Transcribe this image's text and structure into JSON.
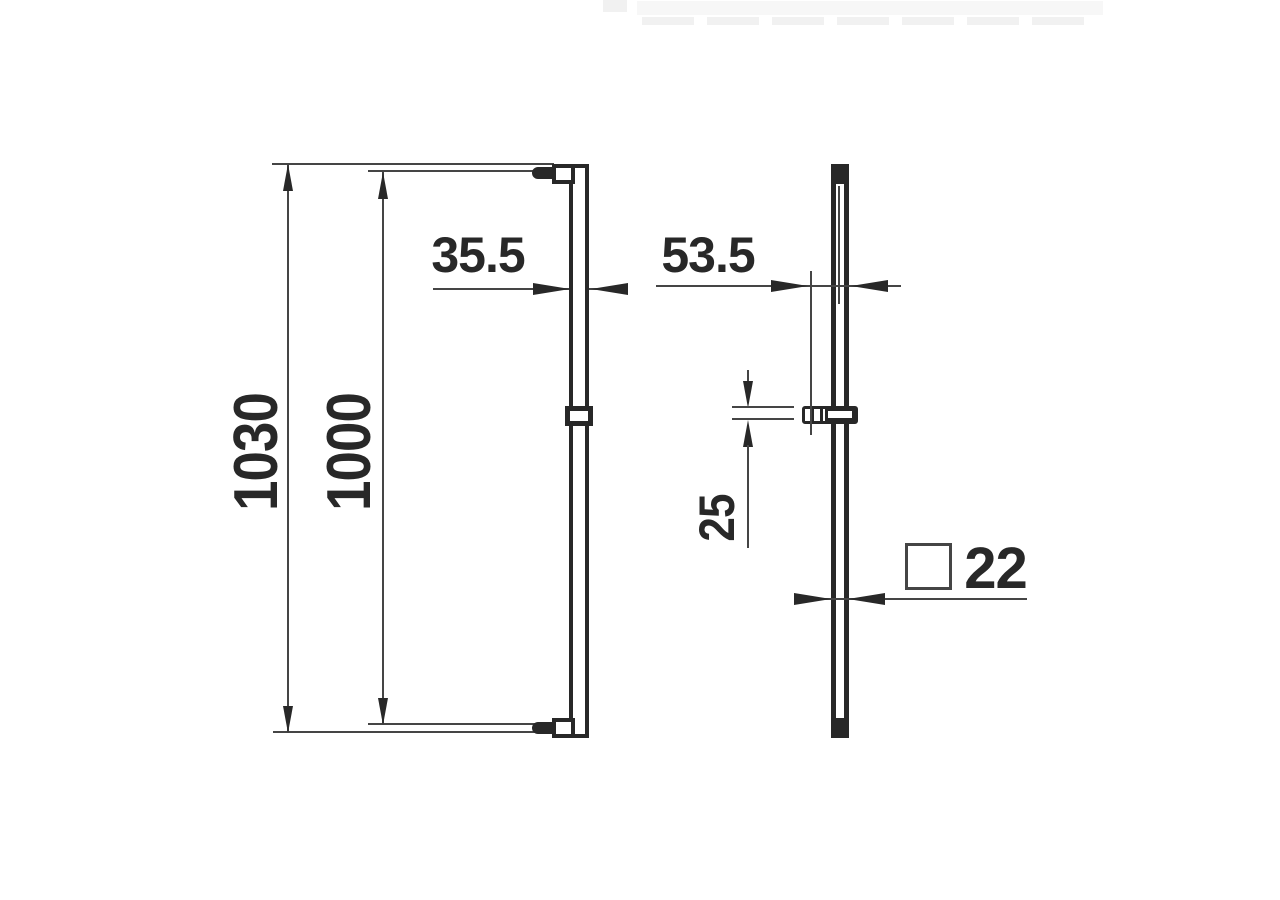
{
  "views": {
    "front": {
      "dim_overall_height": "1030",
      "dim_rail_height": "1000",
      "dim_top_width": "35.5"
    },
    "side": {
      "dim_wall_distance": "53.5",
      "dim_holder_height": "25",
      "dim_profile": "22"
    }
  },
  "icons": {
    "profile_symbol": "square-outline"
  },
  "colors": {
    "ink": "#282828",
    "thin_line": "#454545",
    "background": "#ffffff"
  }
}
